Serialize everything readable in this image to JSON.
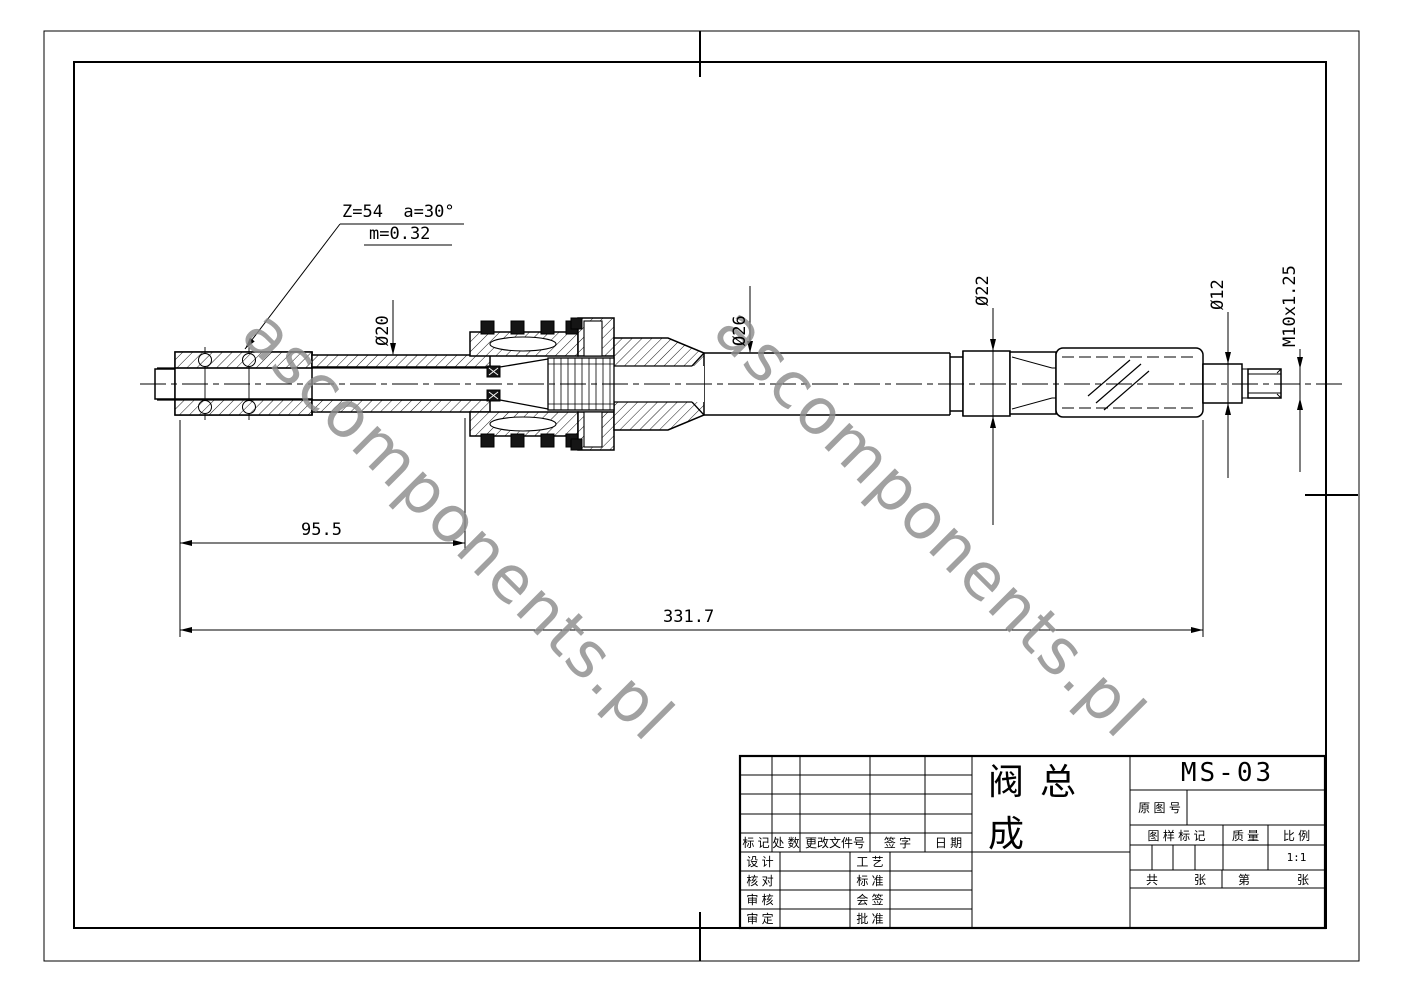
{
  "watermark": {
    "text": "ascomponents.pl"
  },
  "annotations": {
    "spline_note_1": "Z=54  a=30°",
    "spline_note_2": "m=0.32",
    "dia_20": "Ø20",
    "dia_26": "Ø26",
    "dia_22": "Ø22",
    "dia_12": "Ø12",
    "thread": "M10x1.25",
    "len_95": "95.5",
    "len_331": "331.7"
  },
  "title_block": {
    "part_name": "阀总成",
    "drawing_no": "MS-03",
    "original_no": "原 图 号",
    "pattern_mark": "图 样 标 记",
    "mass": "质 量",
    "scale": "比 例",
    "scale_value": "1:1",
    "total_prefix": "共",
    "total_suffix": "张",
    "sheet_prefix": "第",
    "sheet_suffix": "张"
  },
  "revision_table": {
    "header": [
      "标 记",
      "处 数",
      "更改文件号",
      "签  字",
      "日  期"
    ],
    "roles_left": [
      "设 计",
      "核 对",
      "审 核",
      "审 定"
    ],
    "roles_right": [
      "工 艺",
      "标 准",
      "会 签",
      "批 准"
    ]
  }
}
